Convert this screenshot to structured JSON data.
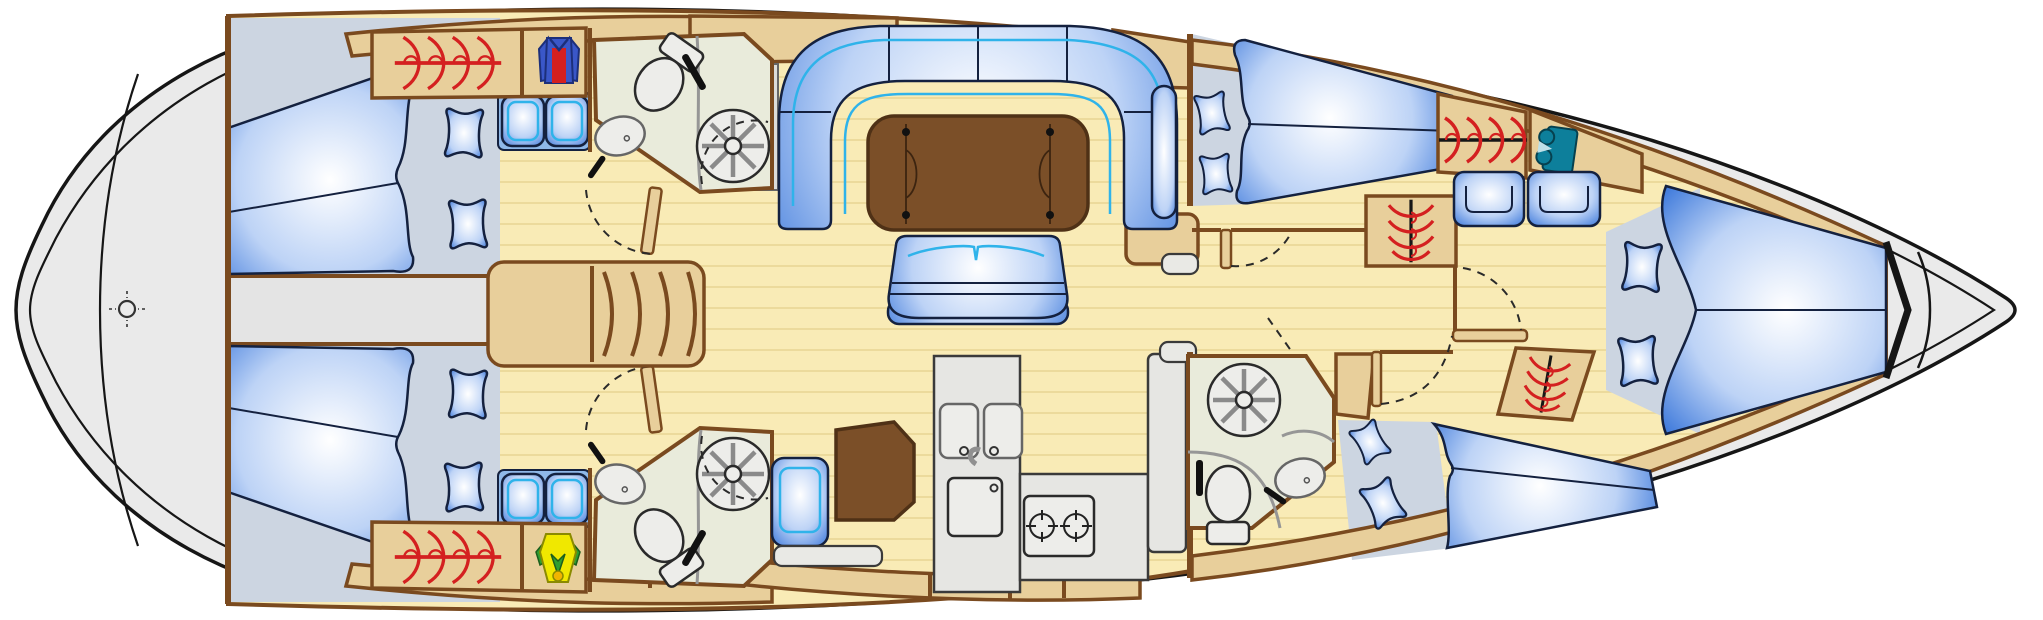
{
  "diagram": {
    "kind": "sailing-yacht-interior-deck-plan",
    "view": "top-down",
    "orientation": {
      "bow": "right",
      "stern": "left"
    }
  },
  "palette": {
    "hull": "#eaeaea",
    "hullStroke": "#161616",
    "deck": "#e4e4e4",
    "floor": "#f9ebb6",
    "plank": "#e7d494",
    "wood": "#e8cf9b",
    "woodStroke": "#7a4a1f",
    "woodDark": "#7b4f28",
    "woodDarkStroke": "#4f3116",
    "berthBase": "#ccd5e1",
    "headFloor": "#e9ebdb",
    "fixture": "#ededea",
    "fixtureStroke": "#2a2a2a",
    "partition": "#969696",
    "counter": "#e6e6e3",
    "stepFill": "#e9e9e5",
    "cushionDeep": "#2f6fd8",
    "cushionMid": "#bdd3f6",
    "cushionLight": "#ffffff",
    "cushionStroke": "#14213f",
    "piping": "#2fb3ea",
    "seatBase": "#8fb8e8",
    "red": "#d42020",
    "shirtBlue": "#3a57c8",
    "shirtBlueDark": "#1c2f7a",
    "yellow": "#f0e800",
    "green": "#2f9e30",
    "greenDark": "#1c5e1c",
    "teal": "#0d7f9b",
    "tealDark": "#06414f"
  },
  "areas": {
    "swim_platform": {
      "label": "Stern swim platform"
    },
    "aft_deck": {
      "label": "Aft deck over aft cabins"
    },
    "aft_cabin_port": {
      "label": "Aft double cabin, port side"
    },
    "aft_cabin_starboard": {
      "label": "Aft double cabin, starboard side"
    },
    "head_aft_port": {
      "label": "Aft head with shower, port side"
    },
    "head_aft_starboard": {
      "label": "Aft head with shower, starboard side"
    },
    "companionway": {
      "label": "Companionway steps"
    },
    "salon": {
      "label": "Salon with U-settee, folding table and bench"
    },
    "galley": {
      "label": "Galley with double sink, fridge and two-burner stove"
    },
    "nav_station": {
      "label": "Navigation station with chart table and seat"
    },
    "cabin_fwd_port": {
      "label": "Forward cabin, port side"
    },
    "cabin_fwd_starboard": {
      "label": "Forward cabin, starboard side"
    },
    "head_forward": {
      "label": "Forward head with shower"
    },
    "lounge_forward": {
      "label": "Forward seats and hanging lockers"
    },
    "bow_cabin": {
      "label": "Bow V-berth cabin"
    },
    "anchor_locker": {
      "label": "Anchor locker at bow"
    }
  },
  "icons": {
    "hanging_locker": "red clothes-hanger symbol",
    "wardrobe_shirt": "red and blue shirt symbol",
    "wet_gear_locker": "yellow and green jacket symbol",
    "linen_locker": "teal folded-clothes symbol",
    "shower": "circle with eight spokes",
    "toilet": "bowl with cistern",
    "sink": "oval basin with faucet",
    "stove": "two burner rings",
    "rudder_post": "small crosshair circle on swim platform"
  }
}
